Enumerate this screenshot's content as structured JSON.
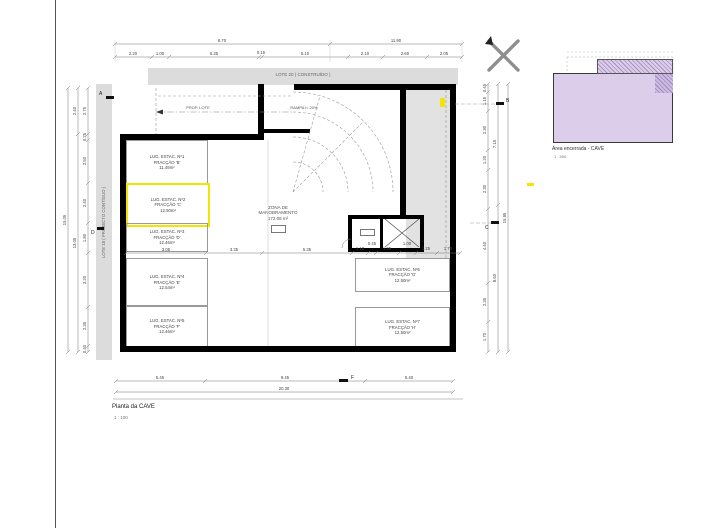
{
  "sheet": {
    "plan_title": "Planta da CAVE",
    "plan_scale": "1 : 100",
    "inset_title": "Área encerrada - CAVE",
    "inset_scale": "1 : 500"
  },
  "context": {
    "lote_top": "LOTE 20 ( CONSTRUÍDO )",
    "lote_left": "LOTE 18 ( PROJECTO CONTÍGUO )"
  },
  "zones": {
    "maneuver": {
      "line1": "ZONA DE",
      "line2": "MANOBRAMENTO",
      "line3": "172.08 m²"
    }
  },
  "ramp": {
    "label_left": "PROP. LOTE",
    "label_right": "RAMPA i= 20%"
  },
  "stalls": [
    {
      "lines": [
        "LUG. ESTAC. Nº1",
        "FRACÇÃO 'B'",
        "11.49m²"
      ],
      "highlighted": false
    },
    {
      "lines": [
        "LUG. ESTAC. Nº2",
        "FRACÇÃO 'C'",
        "12.50m²"
      ],
      "highlighted": true
    },
    {
      "lines": [
        "LUG. ESTAC. Nº3",
        "FRACÇÃO 'D'",
        "12.46m²"
      ],
      "highlighted": false
    },
    {
      "lines": [
        "LUG. ESTAC. Nº4",
        "FRACÇÃO 'E'",
        "12.54m²"
      ],
      "highlighted": false
    },
    {
      "lines": [
        "LUG. ESTAC. Nº5",
        "FRACÇÃO 'F'",
        "12.46m²"
      ],
      "highlighted": false
    },
    {
      "lines": [
        "LUG. ESTAC. Nº6",
        "FRACÇÃO 'G'",
        "12.50m²"
      ],
      "highlighted": false
    },
    {
      "lines": [
        "LUG. ESTAC. Nº7",
        "FRACÇÃO 'H'",
        "12.50m²"
      ],
      "highlighted": false
    }
  ],
  "markers": {
    "a": "A",
    "b": "B",
    "c": "C",
    "d": "D",
    "f": "F"
  },
  "dims": {
    "top1": [
      "8.70",
      "11.90"
    ],
    "top2": [
      "2.20",
      "1.00",
      "5.35",
      "0.15",
      "5.10",
      "2.10",
      "2.60",
      "2.05"
    ],
    "bottom1": [
      "5.45",
      "9.45",
      "5.40"
    ],
    "bottom2": [
      "20.30"
    ],
    "left_outer": [
      "15.05"
    ],
    "left_mid": [
      "2.40",
      "13.05"
    ],
    "left_inner": [
      "2.75",
      "0.25",
      "2.50",
      "2.40",
      "1.80",
      "3.20",
      "2.35",
      "0.40"
    ],
    "right_inner": [
      "0.45",
      "1.15",
      "2.30",
      "1.20",
      "2.30",
      "4.40",
      "2.35",
      "1.70"
    ],
    "right_mid": [
      "7.15",
      "8.60"
    ],
    "right_outer": [
      "15.95"
    ],
    "interior": [
      "3.05",
      "3.35",
      "5.35",
      "1.10",
      "0.45",
      "1.35",
      "1.00",
      "1.25",
      "1.70"
    ]
  },
  "colors": {
    "highlight_yellow": "#f5e400",
    "parcel_fill": "#dccdea",
    "context_gray": "#dcdcdc",
    "wall_black": "#000000"
  }
}
